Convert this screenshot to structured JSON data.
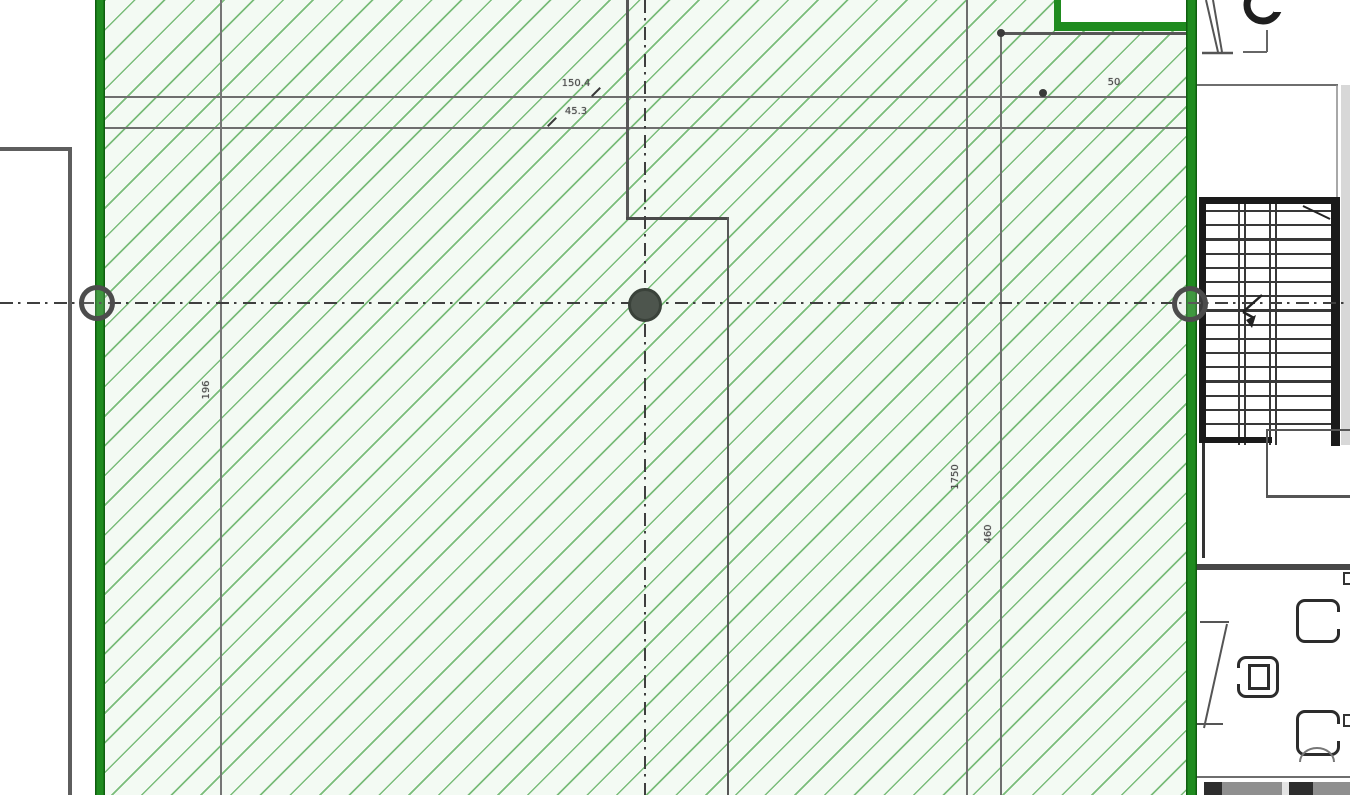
{
  "drawing": {
    "kind": "architectural-floor-plan-detail",
    "dims": {
      "top_primary": "150.4",
      "top_secondary": "45.3",
      "right_offset": "50",
      "left_vertical": "196",
      "column_vertical_a": "1750",
      "column_vertical_b": "460"
    },
    "colors": {
      "wall_green": "#1f8b1f",
      "hatch_line": "#7abc7a",
      "hatch_bg": "#f3faf3",
      "line_gray": "#6e6e6e",
      "dark_line": "#333333",
      "centerline": "#3f3f3f"
    },
    "stair": {
      "step_count": 16
    }
  }
}
